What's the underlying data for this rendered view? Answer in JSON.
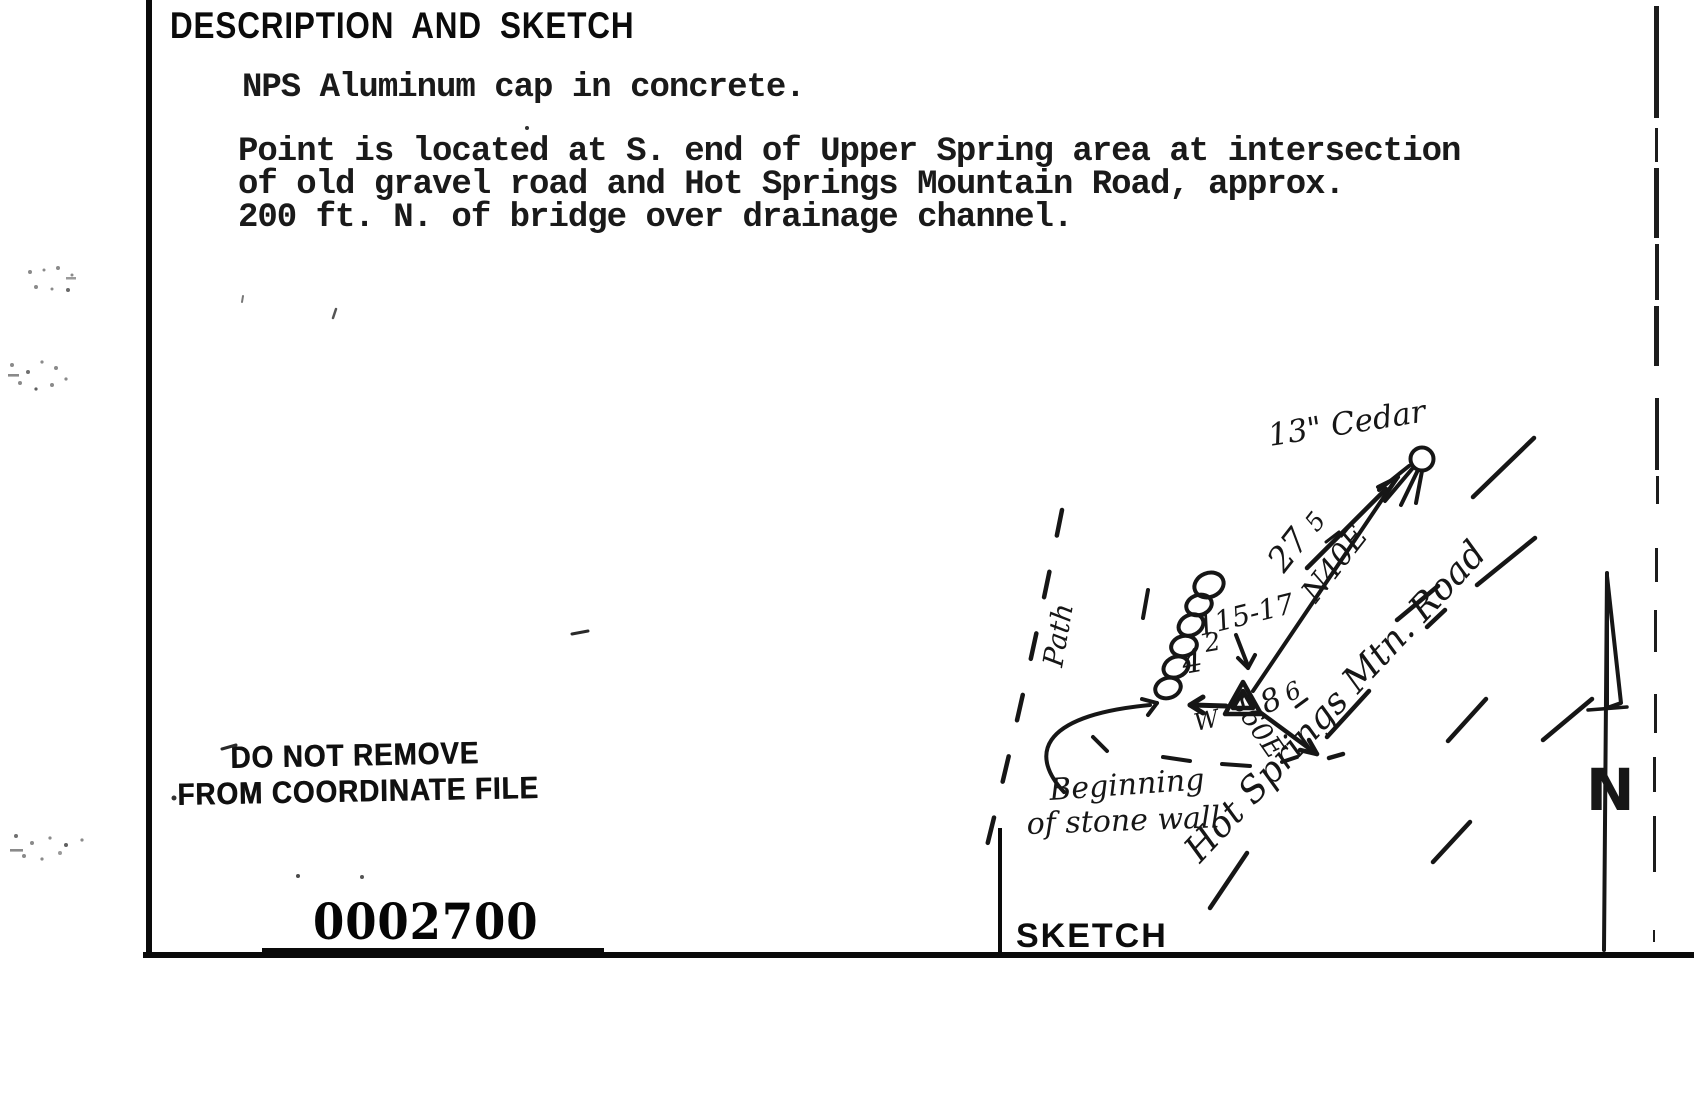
{
  "header": {
    "title": "DESCRIPTION AND SKETCH"
  },
  "description": {
    "line_intro": "NPS Aluminum cap in concrete.",
    "para_line1": "Point is located at S. end of Upper Spring area at intersection",
    "para_line2": "of old gravel road and Hot Springs Mountain Road, approx.",
    "para_line3": "200 ft. N. of bridge over drainage channel."
  },
  "stamp": {
    "line1": "DO NOT REMOVE",
    "line2": "FROM COORDINATE FILE"
  },
  "coordinate_number": "0002700",
  "sketch": {
    "section_label": "SKETCH",
    "cedar_label": "13\" Cedar",
    "path_label": "Path",
    "point_id": "115-17",
    "cedar_tie": {
      "distance_whole": "27",
      "distance_tenths": "5",
      "bearing": "N40E"
    },
    "wall_tie": {
      "distance_whole": "4",
      "distance_tenths": "2",
      "bearing": "W"
    },
    "road_tie": {
      "distance_whole": "8",
      "distance_tenths": "6",
      "bearing": "S60E"
    },
    "wall_note_line1": "Beginning",
    "wall_note_line2": "of stone wall",
    "road_label": "Hot Springs Mtn. Road",
    "north_arrow_label": "N"
  }
}
